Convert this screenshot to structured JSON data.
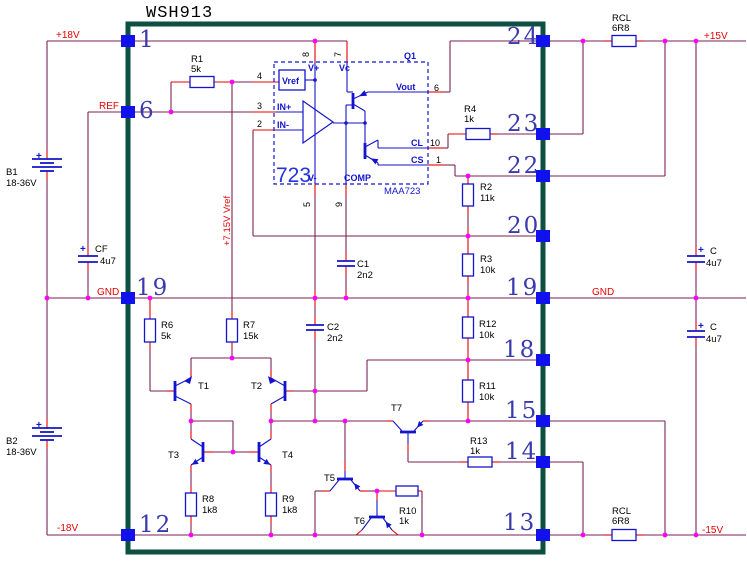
{
  "title": "WSH913",
  "nets": {
    "p18": "+18V",
    "ref": "REF",
    "gndl": "GND",
    "n18": "-18V",
    "p15": "+15V",
    "gndr": "GND",
    "n15": "-15V",
    "vref": "+7.15V Vref"
  },
  "pins": {
    "p1": "1",
    "p6": "6",
    "p19l": "19",
    "p12": "12",
    "p24": "24",
    "p23": "23",
    "p22": "22",
    "p20": "20",
    "p19r": "19",
    "p18": "18",
    "p15": "15",
    "p14": "14",
    "p13": "13"
  },
  "ic": {
    "big": "723",
    "part": "MAA723",
    "q1": "Q1",
    "vrefbox": "Vref",
    "vplus": "V+",
    "vc": "Vc",
    "inp": "IN+",
    "inn": "IN-",
    "vout": "Vout",
    "cl": "CL",
    "cs": "CS",
    "vminus": "V-",
    "comp": "COMP",
    "n8": "8",
    "n7": "7",
    "n4": "4",
    "n3": "3",
    "n2": "2",
    "n6": "6",
    "n10": "10",
    "n1": "1",
    "n5": "5",
    "n9": "9"
  },
  "parts": {
    "r1": [
      "R1",
      "5k"
    ],
    "r2": [
      "R2",
      "11k"
    ],
    "r3": [
      "R3",
      "10k"
    ],
    "r4": [
      "R4",
      "1k"
    ],
    "r6": [
      "R6",
      "5k"
    ],
    "r7": [
      "R7",
      "15k"
    ],
    "r8": [
      "R8",
      "1k8"
    ],
    "r9": [
      "R9",
      "1k8"
    ],
    "r10": [
      "R10",
      "1k"
    ],
    "r11": [
      "R11",
      "10k"
    ],
    "r12": [
      "R12",
      "10k"
    ],
    "r13": [
      "R13",
      "1k"
    ],
    "rcl1": [
      "RCL",
      "6R8"
    ],
    "rcl2": [
      "RCL",
      "6R8"
    ],
    "c1": [
      "C1",
      "2n2"
    ],
    "c2": [
      "C2",
      "2n2"
    ],
    "cf": [
      "CF",
      "4u7"
    ],
    "ct": [
      "C",
      "4u7"
    ],
    "cb": [
      "C",
      "4u7"
    ],
    "b1": [
      "B1",
      "18-36V"
    ],
    "b2": [
      "B2",
      "18-36V"
    ],
    "t1": "T1",
    "t2": "T2",
    "t3": "T3",
    "t4": "T4",
    "t5": "T5",
    "t6": "T6",
    "t7": "T7",
    "plus": "+"
  },
  "colors": {
    "wire": "#7b2256",
    "lead": "#e80000",
    "component": "#1414cc",
    "pin_square": "#1111ee",
    "junction": "#ff00ff",
    "module_border": "#0d4f41",
    "pin_number": "#3a3aad",
    "net_label": "#e80000",
    "background": "#ffffff"
  }
}
